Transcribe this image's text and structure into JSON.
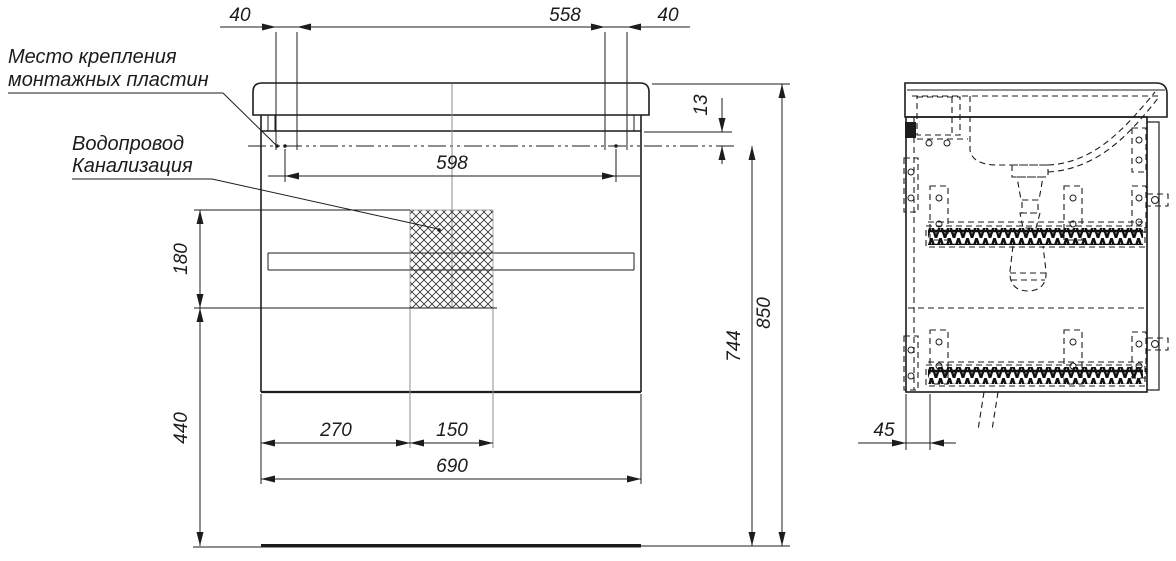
{
  "annotations": {
    "mounting_line1": "Место крепления",
    "mounting_line2": "монтажных пластин",
    "plumbing_line1": "Водопровод",
    "plumbing_line2": "Канализация"
  },
  "dimensions": {
    "top_offset_left": "40",
    "top_span": "558",
    "top_offset_right": "40",
    "apron_drop": "13",
    "inner_width": "598",
    "hatch_height": "180",
    "lower_height": "440",
    "hatch_offset": "270",
    "hatch_width": "150",
    "cabinet_width": "690",
    "body_height": "744",
    "total_height": "850",
    "side_back_offset": "45"
  },
  "colors": {
    "line": "#1c1c1c",
    "light": "#8f8f8f",
    "background": "#ffffff"
  }
}
